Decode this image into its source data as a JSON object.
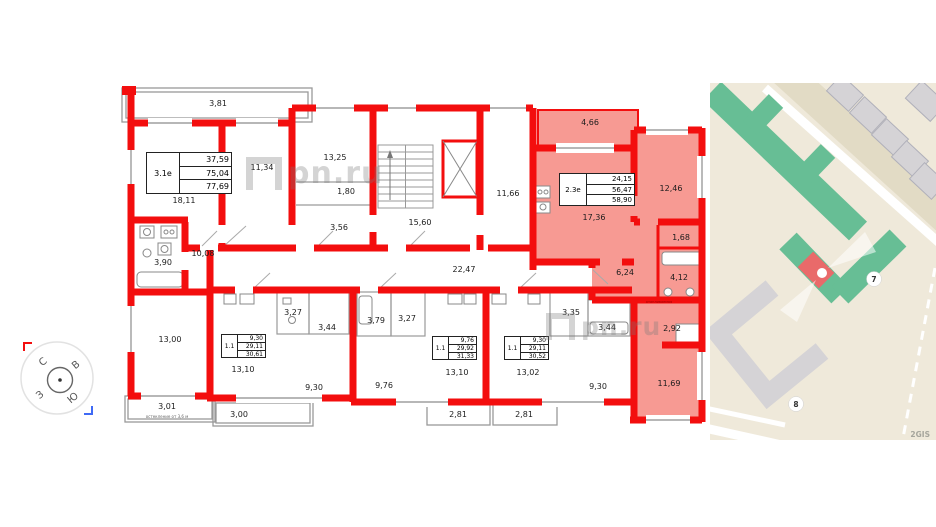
{
  "floorplan": {
    "room_labels": [
      "3,81",
      "18,11",
      "11,34",
      "13,25",
      "1,80",
      "3,56",
      "10,08",
      "3,90",
      "15,60",
      "11,66",
      "4,66",
      "17,36",
      "12,46",
      "1,68",
      "6,24",
      "4,12",
      "3,35",
      "3,44",
      "2,92",
      "9,30",
      "11,69",
      "13,00",
      "3,01",
      "3,27",
      "3,44",
      "13,10",
      "9,30",
      "3,00",
      "22,47",
      "3,79",
      "3,27",
      "9,76",
      "13,10",
      "2,81",
      "13,02",
      "2,81"
    ],
    "apartments": [
      {
        "id": "3.1е",
        "living": "37,59",
        "area": "75,04",
        "total": "77,69"
      },
      {
        "id": "2.3е",
        "living": "24,15",
        "area": "56,47",
        "total": "58,90"
      },
      {
        "id": "1.1",
        "living": "9,30",
        "area": "29,11",
        "total": "30,61"
      },
      {
        "id": "1.1",
        "living": "9,76",
        "area": "29,92",
        "total": "31,33"
      },
      {
        "id": "1.1",
        "living": "9,30",
        "area": "29,11",
        "total": "30,52"
      }
    ],
    "notes": {
      "glazing": "остекление от 3,6 м",
      "heated": "отапливаемая"
    },
    "compass": {
      "north": "С",
      "east": "В",
      "south": "Ю",
      "west": "З"
    },
    "colors": {
      "wall": "#f30e0e",
      "highlight": "#f79a93"
    }
  },
  "watermark": {
    "text": "pn.ru"
  },
  "map": {
    "badges": [
      "7",
      "8"
    ],
    "attribution": "2GIS",
    "colors": {
      "background": "#efe9da",
      "building_green": "#67be95",
      "building_gray": "#d5d3d6",
      "selected_building": "#e96a6a"
    }
  }
}
